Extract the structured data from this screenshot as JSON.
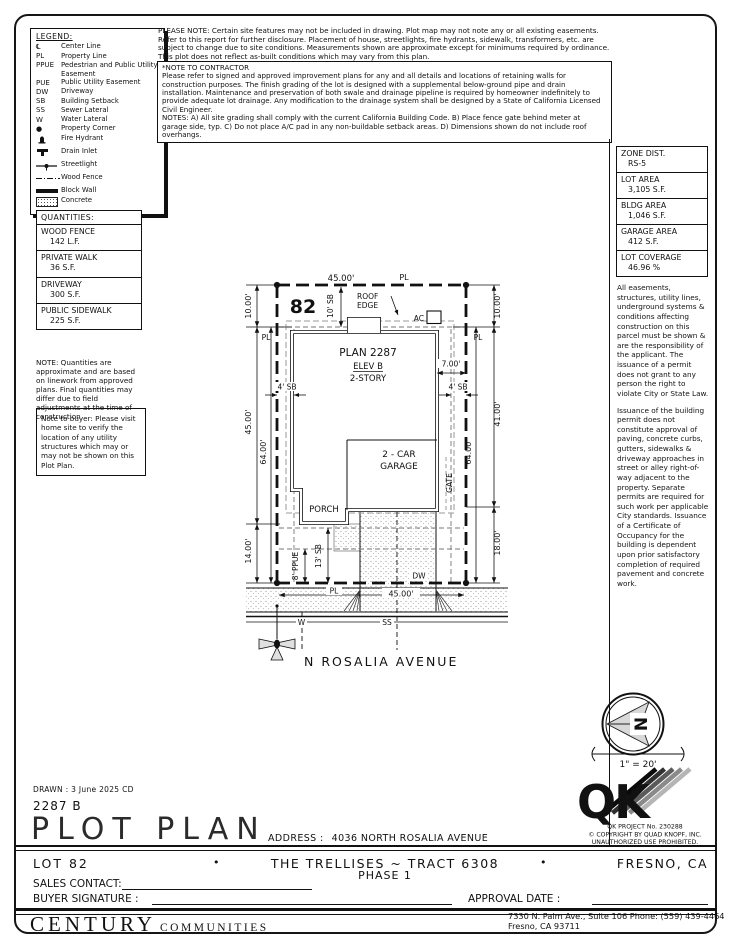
{
  "notices": {
    "please_note": "PLEASE NOTE:  Certain site features may not be included in drawing.  Plot map may not note any or all existing easements.  Refer to this report for further disclosure.  Placement of house, streetlights, fire hydrants, sidewalk, transformers, etc. are subject to change due to site conditions.  Measurements shown are approximate except for minimums required by ordinance.  This plot does not reflect as-built conditions which may vary from this plan.",
    "contractor_title": "*NOTE TO CONTRACTOR",
    "contractor_body": "Please refer to signed and approved improvement plans for any and all details and locations of retaining walls for construction purposes. The finish grading of the lot is designed with a supplemental below-ground pipe and drain installation. Maintenance and preservation of both swale and drainage pipeline is required by homeowner indefinitely to provide adequate lot drainage. Any modification to the drainage system shall be designed by a State of California Licensed Civil Engineer.",
    "contractor_notes": "NOTES:  A) All site grading shall comply with the current California Building Code.  B) Place fence gate behind meter at garage side, typ.  C) Do not place A/C pad in any non-buildable setback areas.  D) Dimensions shown do not include roof overhangs.",
    "buyer_note": "Note to buyer: Please visit home site to verify the location of any utility structures which may or may not be shown on this Plot Plan.",
    "easement_p1": "All easements, structures, utility lines, underground systems & conditions affecting construction on this parcel must be shown & are the responsibility of the applicant. The issuance of a permit does not grant to any person the right to violate City or State Law.",
    "easement_p2": "Issuance of the building permit does not constitute approval of paving, concrete curbs, gutters, sidewalks & driveway approaches in street or alley right-of-way adjacent to the property. Separate permits are required for such work per applicable City standards. Issuance of a Certificate of Occupancy for the building is dependent upon prior satisfactory completion of required pavement and concrete work."
  },
  "legend": {
    "title": "LEGEND:",
    "items": [
      {
        "abbr": "℄",
        "label": "Center Line"
      },
      {
        "abbr": "PL",
        "label": "Property Line"
      },
      {
        "abbr": "PPUE",
        "label": "Pedestrian and Public Utility Easement"
      },
      {
        "abbr": "PUE",
        "label": "Public Utility Easement"
      },
      {
        "abbr": "DW",
        "label": "Driveway"
      },
      {
        "abbr": "SB",
        "label": "Building Setback"
      },
      {
        "abbr": "SS",
        "label": "Sewer Lateral"
      },
      {
        "abbr": "W",
        "label": "Water Lateral"
      },
      {
        "abbr": "●",
        "label": "Property Corner"
      },
      {
        "abbr": "",
        "label": "Fire Hydrant"
      },
      {
        "abbr": "",
        "label": "Drain Inlet"
      },
      {
        "abbr": "",
        "label": "Streetlight"
      },
      {
        "abbr": "",
        "label": "Wood Fence"
      },
      {
        "abbr": "",
        "label": "Block Wall"
      },
      {
        "abbr": "",
        "label": "Concrete"
      }
    ]
  },
  "site_data": {
    "boxes": [
      {
        "label": "ZONE DIST.",
        "value": "RS-5"
      },
      {
        "label": "LOT AREA",
        "value": "3,105 S.F."
      },
      {
        "label": "BLDG AREA",
        "value": "1,046 S.F."
      },
      {
        "label": "GARAGE AREA",
        "value": "412 S.F."
      },
      {
        "label": "LOT COVERAGE",
        "value": "46.96 %"
      }
    ]
  },
  "quantities": {
    "title": "QUANTITIES:",
    "items": [
      {
        "label": "WOOD FENCE",
        "value": "142 L.F."
      },
      {
        "label": "PRIVATE WALK",
        "value": "36 S.F."
      },
      {
        "label": "DRIVEWAY",
        "value": "300 S.F."
      },
      {
        "label": "PUBLIC SIDEWALK",
        "value": "225 S.F."
      }
    ],
    "note": "NOTE: Quantities are approximate and are based on linework from approved plans.  Final quantities may differ due to field adjustments at the time of construction."
  },
  "plot": {
    "lot_number": "82",
    "dim_top": "45.00'",
    "dim_bottom": "45.00'",
    "dim_left_10": "10.00'",
    "dim_left_45": "45.00'",
    "dim_left_14": "14.00'",
    "dim_left_64": "64.00'",
    "dim_right_10": "10.00'",
    "dim_right_41": "41.00'",
    "dim_right_18": "18.00'",
    "dim_right_64": "64.00'",
    "dim_7": "7.00'",
    "sb_front": "10' SB",
    "sb_left": "4' SB",
    "sb_right": "4' SB",
    "sb_rear": "13' SB",
    "ppue": "8' PPUE",
    "pl": "PL",
    "roof_line1": "ROOF",
    "roof_line2": "EDGE",
    "ac": "AC",
    "plan_name": "PLAN 2287",
    "elev": "ELEV B",
    "story": "2-STORY",
    "garage_line1": "2 - CAR",
    "garage_line2": "GARAGE",
    "porch": "PORCH",
    "gate": "GATE",
    "dw": "DW",
    "water": "W",
    "sewer": "SS",
    "street": "N ROSALIA AVENUE"
  },
  "compass": {
    "north": "N",
    "scale": "1\" = 20'"
  },
  "qk": {
    "logo": "QK",
    "project": "QK PROJECT No. 230288",
    "copyright": "© COPYRIGHT BY QUAD KNOPF, INC.",
    "rights": "UNAUTHORIZED USE PROHIBITED."
  },
  "titleblock": {
    "drawn": "DRAWN : 3 June 2025  CD",
    "plan_number": "2287 B",
    "title": "PLOT PLAN",
    "address_label": "ADDRESS :",
    "address": "4036 NORTH ROSALIA AVENUE",
    "lot": "LOT 82",
    "bullet": "•",
    "community": "THE TRELLISES ~ TRACT 6308",
    "phase": "PHASE 1",
    "city": "FRESNO, CA",
    "sales_contact": "SALES CONTACT:",
    "buyer_signature": "BUYER SIGNATURE :",
    "approval_date": "APPROVAL DATE :",
    "builder_name": "CENTURY",
    "builder_suffix": "COMMUNITIES",
    "builder_address": "7330 N. Palm Ave., Suite 106    Phone:  (559) 439-4464",
    "builder_city": "Fresno, CA  93711"
  }
}
